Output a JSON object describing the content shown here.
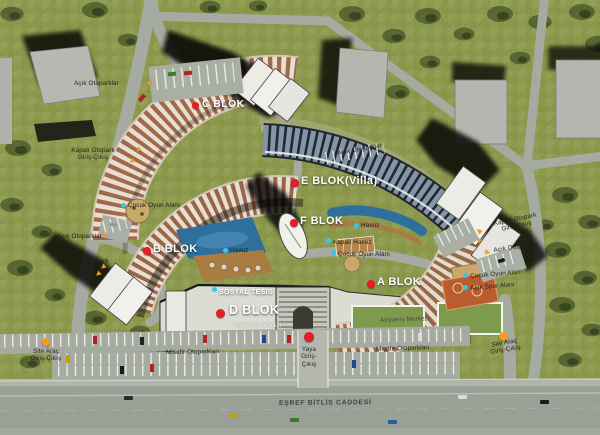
{
  "site": {
    "street_name": "EŞREF BİTLİS CADDESİ"
  },
  "blocks": {
    "a": "A BLOK",
    "b": "B BLOK",
    "c": "C BLOK",
    "d": "D BLOK",
    "e": "E BLOK(Villa)",
    "f": "F BLOK"
  },
  "facilities": {
    "sosyal_tesis": "SOSYAL TESİS",
    "alisveris_merkezi": "Alışveriş Merkezi",
    "havuz": "Havuz",
    "kapali_havuz": "Kapalı Havuz",
    "cocuk_oyun_alani": "Çocuk Oyun Alanı",
    "acik_spor_alani": "Açık Spor Alanı"
  },
  "access": {
    "acik_otoparklar": "Açık Otoparklar",
    "kapali_otopark": "Kapalı Otopark",
    "giris_cikis": "Giriş-Çıkış",
    "misafir_otoparklari": "Misafir Otoparkları",
    "site_arac": "Site Araç",
    "yaya": "Yaya"
  },
  "markers": {
    "block_dot_color": "#e31e24",
    "amenity_dot_color": "#35c7ec",
    "entrance_color": "#f59a23"
  }
}
